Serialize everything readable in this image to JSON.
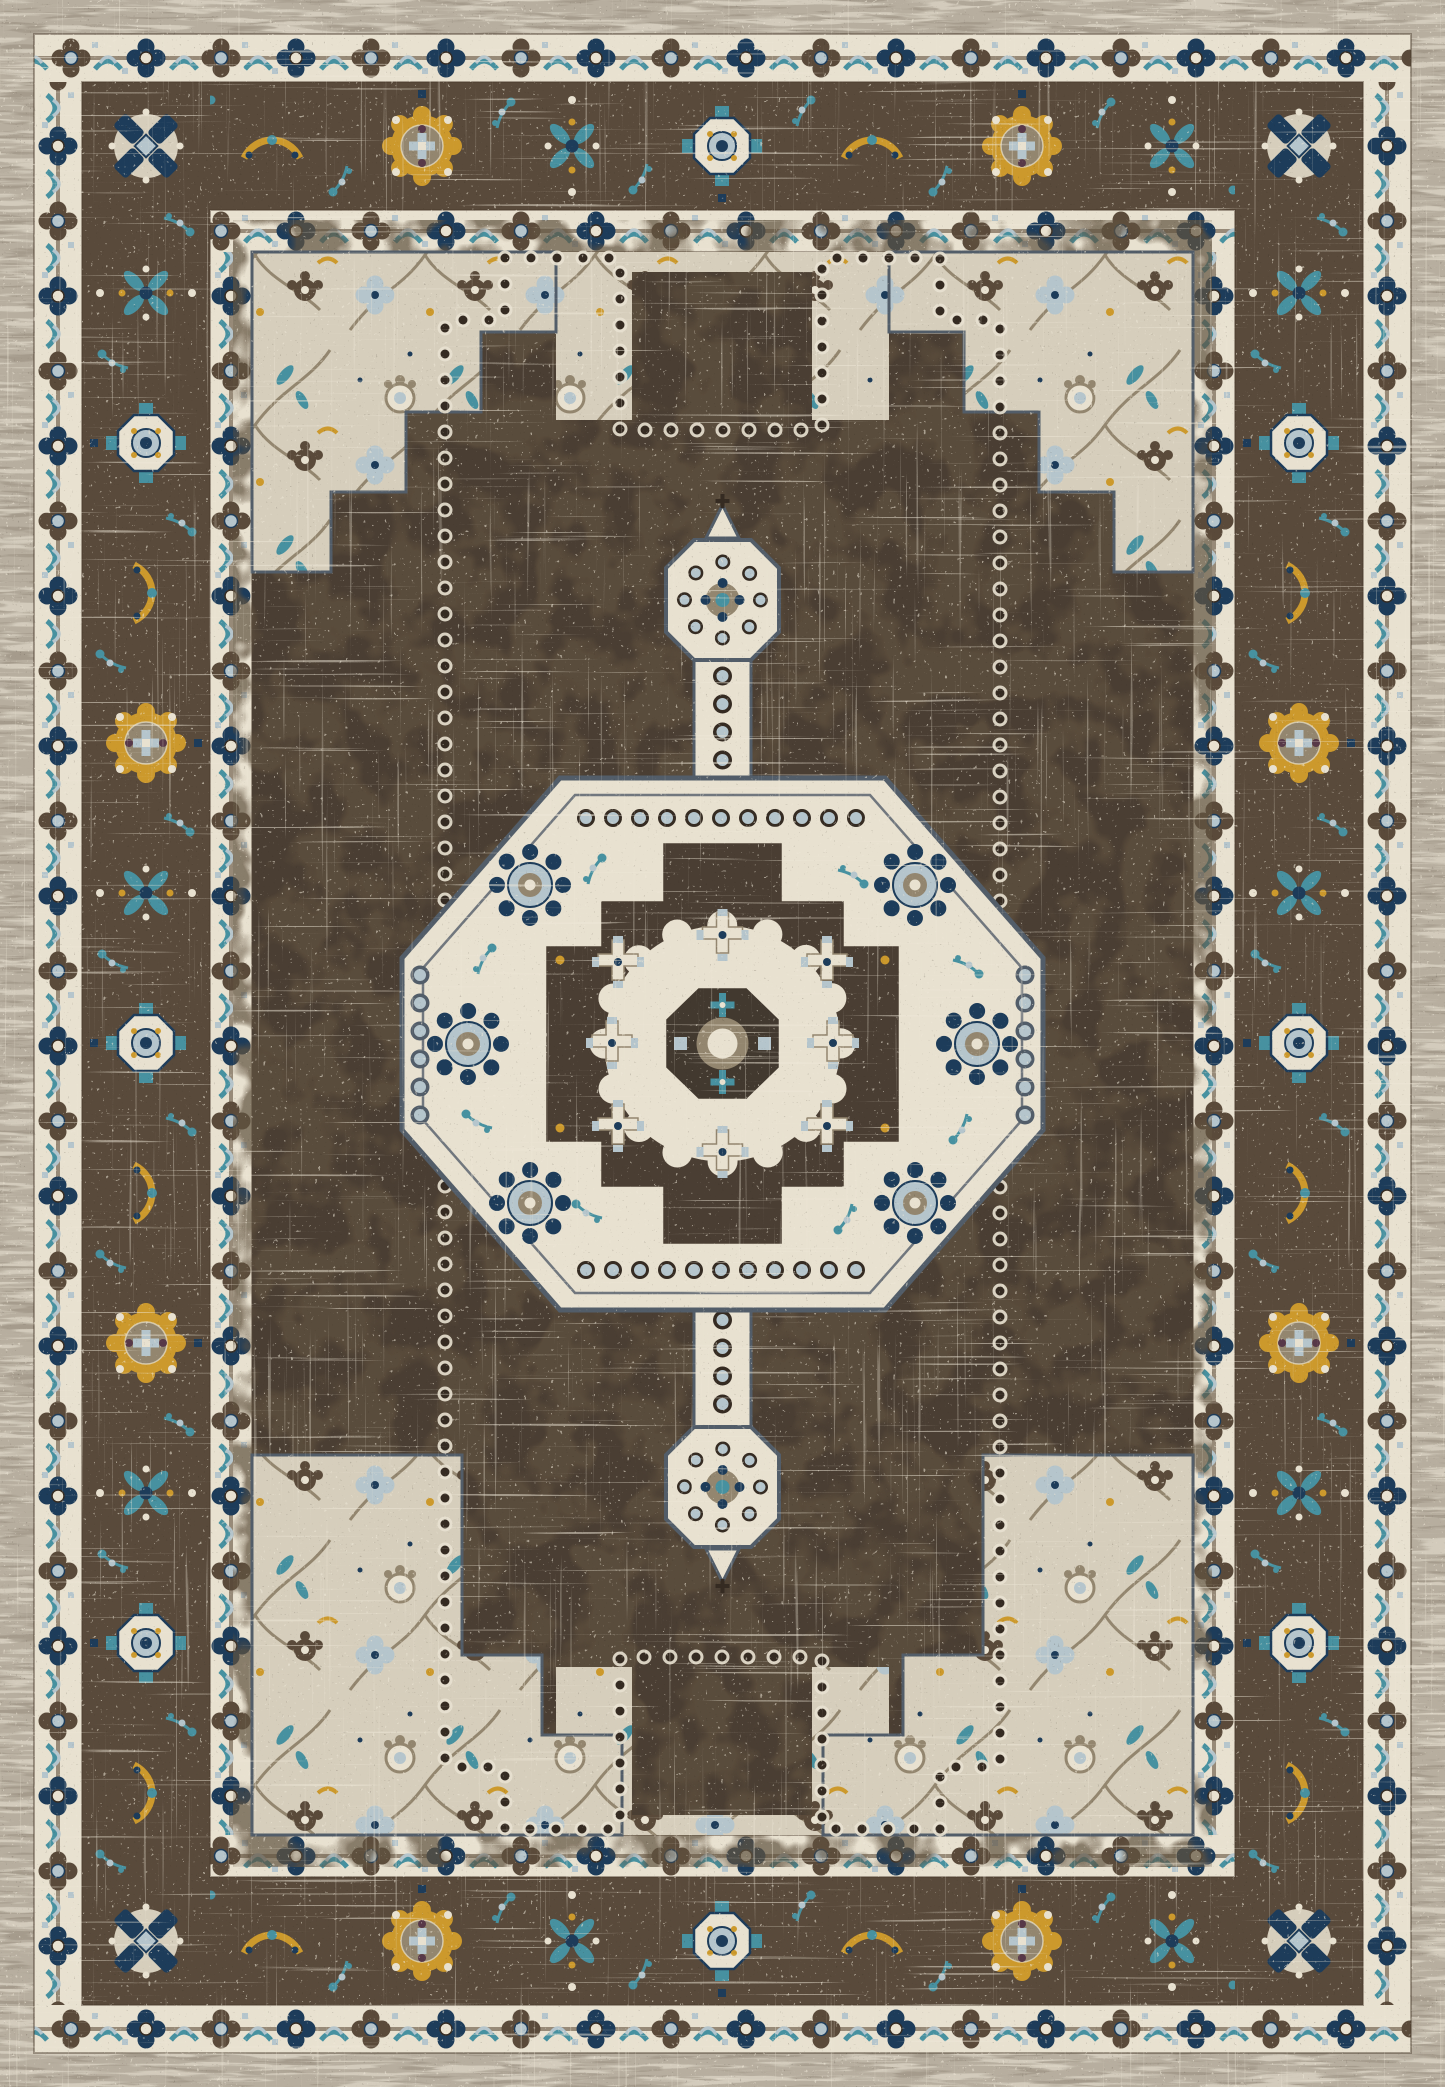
{
  "image": {
    "subject": "Distressed vintage-style oriental medallion area rug, portrait orientation, photographed flat edge to edge",
    "style": "traditional Persian Heriz-style medallion design with heavy antique white-wash distressing and mosaic pixel weave",
    "condition": "distressed / eroded vintage finish"
  },
  "palette": {
    "outer-gray": "#b7ae9f",
    "outer-gray-light": "#d8d1c2",
    "outer-gray-dark": "#9a9081",
    "cream": "#e8e1d0",
    "cream-dark": "#d6cebc",
    "taupe": "#93866f",
    "brown-border": "#594a3b",
    "brown-field": "#4a3e33",
    "brown-dark": "#352b22",
    "navy": "#1d3c5a",
    "teal": "#4791a0",
    "light-blue": "#b5c5cc",
    "gold": "#cc992c",
    "plum": "#573848",
    "distress": "#efe8d8",
    "outline-slate": "#525d69",
    "brown-line": "#6b5a47"
  },
  "structure": {
    "outer_edge": {
      "name": "outer-edge",
      "description": "mottled gray-beige selvage band with horizontal striations"
    },
    "borders": [
      {
        "name": "outer-guard-band",
        "description": "cream band with alternating brown and navy quatrefoil blossoms joined by a vine with paired teal leaves"
      },
      {
        "name": "main-border",
        "description": "dark brown band with gold scalloped rosettes alternating with navy-teal cross medallions and gold leaf sprays; navy X rosettes in the corners"
      },
      {
        "name": "inner-guard-band",
        "description": "cream band repeating the quatrefoil blossom chain"
      }
    ],
    "field": {
      "name": "field",
      "description": "dark chocolate brown distressed ground with stepped ivory corner spandrels filled with taupe, teal and gold floral scrolls, and a dotted stepped panel outline"
    },
    "medallion": {
      "name": "central-medallion",
      "description": "stepped octagonal ivory medallion with beaded edges, navy rosettes, teal sprigs, dark stepped inner panel, central octagon blossom, and pointed pendant finials above and below"
    }
  }
}
